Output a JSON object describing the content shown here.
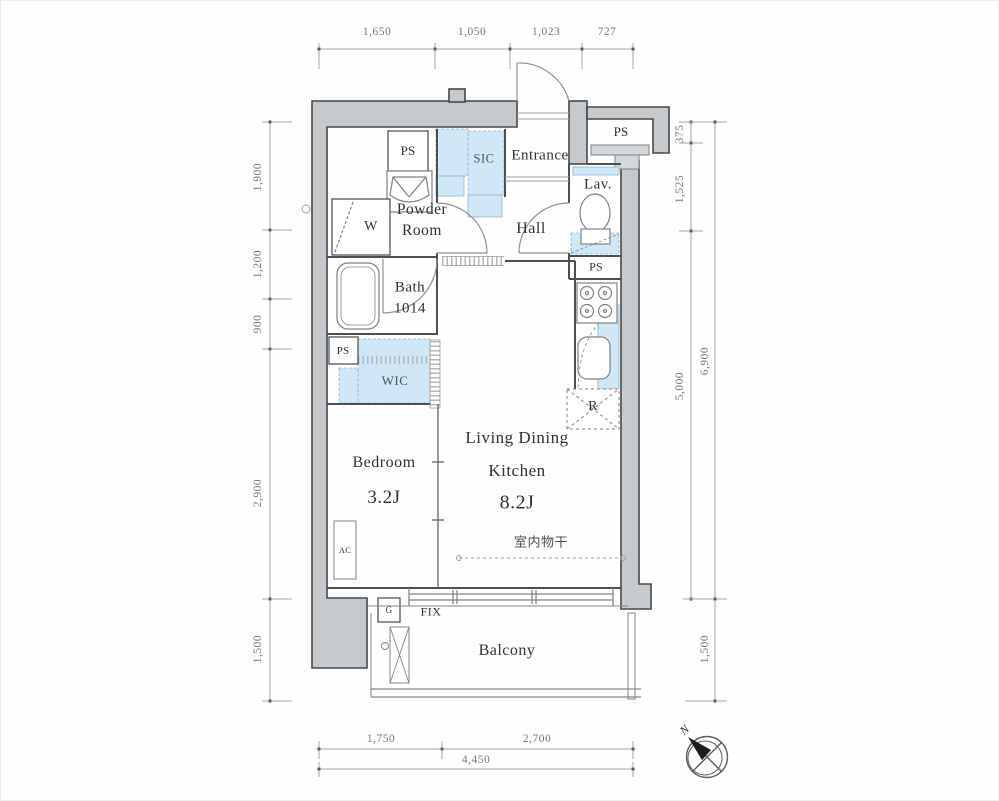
{
  "plan": {
    "rooms": {
      "entrance": "Entrance",
      "sic": "SIC",
      "hall": "Hall",
      "lav": "Lav.",
      "powder_line1": "Powder",
      "powder_line2": "Room",
      "bath_line1": "Bath",
      "bath_line2": "1014",
      "wic": "WIC",
      "bedroom_name": "Bedroom",
      "bedroom_size": "3.2J",
      "ldk_line1": "Living Dining",
      "ldk_line2": "Kitchen",
      "ldk_size": "8.2J",
      "balcony": "Balcony"
    },
    "labels": {
      "ps": "PS",
      "washer": "W",
      "fridge": "R",
      "ac": "AC",
      "gas": "G",
      "fix_window": "FIX",
      "indoor_drying": "室内物干"
    },
    "dimensions": {
      "top": [
        "1,650",
        "1,050",
        "1,023",
        "727"
      ],
      "bottom": [
        "1,750",
        "2,700"
      ],
      "bottom_total": "4,450",
      "left": [
        "1,900",
        "1,200",
        "900",
        "2,900",
        "1,500"
      ],
      "right_inner": [
        "375",
        "1,525",
        "5,000"
      ],
      "right_outer": [
        "6,900",
        "1,500"
      ]
    },
    "compass": {
      "north": "N"
    },
    "colors": {
      "wall_fill": "#c6cacd",
      "accent_blue": "#cfe7f7",
      "line_dark": "#45494d",
      "dim_line": "#a3a8ac",
      "dim_text": "#73787d"
    }
  }
}
